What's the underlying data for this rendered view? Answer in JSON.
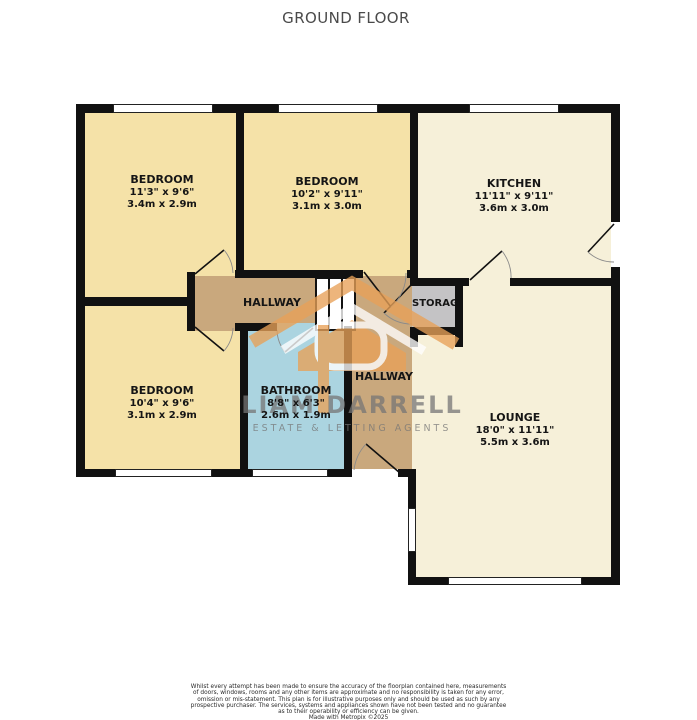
{
  "title": "GROUND FLOOR",
  "rooms": {
    "bedroom1": {
      "name": "BEDROOM",
      "imperial": "11'3\" x 9'6\"",
      "metric": "3.4m x 2.9m"
    },
    "bedroom2": {
      "name": "BEDROOM",
      "imperial": "10'2\" x 9'11\"",
      "metric": "3.1m x 3.0m"
    },
    "kitchen": {
      "name": "KITCHEN",
      "imperial": "11'11\" x 9'11\"",
      "metric": "3.6m x 3.0m"
    },
    "bedroom3": {
      "name": "BEDROOM",
      "imperial": "10'4\" x 9'6\"",
      "metric": "3.1m x 2.9m"
    },
    "bathroom": {
      "name": "BATHROOM",
      "imperial": "8'8\" x 6'3\"",
      "metric": "2.6m x 1.9m"
    },
    "lounge": {
      "name": "LOUNGE",
      "imperial": "18'0\" x 11'11\"",
      "metric": "5.5m x 3.6m"
    },
    "hallway1": {
      "name": "HALLWAY"
    },
    "hallway2": {
      "name": "HALLWAY"
    },
    "storage": {
      "name": "STORAGE"
    }
  },
  "watermark": {
    "brand": "LIAM DARRELL",
    "tagline": "ESTATE & LETTING AGENTS"
  },
  "disclaimer": {
    "lines": [
      "Whilst every attempt has been made to ensure the accuracy of the floorplan contained here, measurements",
      "of doors, windows, rooms and any other items are approximate and no responsibility is taken for any error,",
      "omission or mis-statement. This plan is for illustrative purposes only and should be used as such by any",
      "prospective purchaser. The services, systems and appliances shown have not been tested and no guarantee",
      "as to their operability or efficiency can be given."
    ],
    "credit": "Made with Metropix ©2025"
  },
  "colors": {
    "bedroom": "#F5E2A8",
    "kitchen_lounge": "#F6F0D9",
    "hallway": "#C9A87D",
    "bathroom": "#ABD4E0",
    "storage": "#C4C3C5",
    "wall": "#111111",
    "watermark_orange": "#E8A158",
    "watermark_text": "#8A8A8A"
  }
}
